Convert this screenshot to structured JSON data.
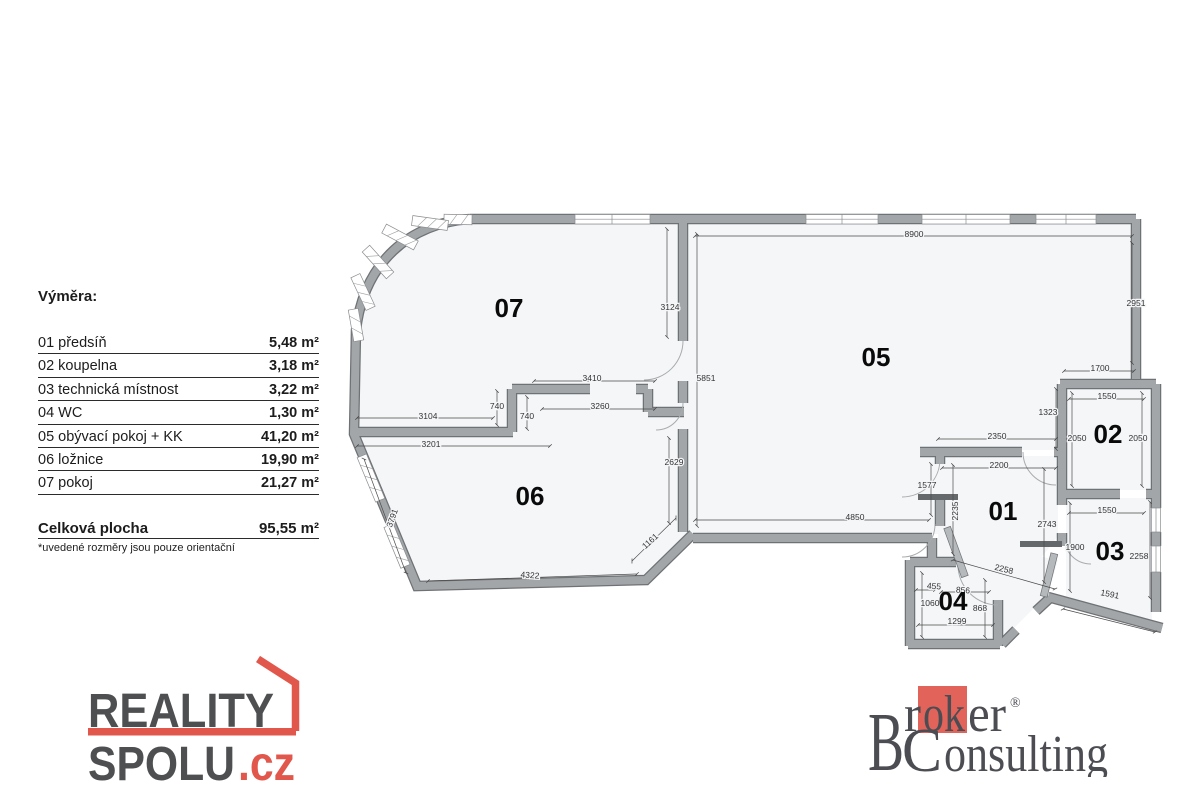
{
  "legend": {
    "title": "Výměra:",
    "rows": [
      {
        "label": "01 předsíň",
        "area": "5,48 m²"
      },
      {
        "label": "02 koupelna",
        "area": "3,18 m²"
      },
      {
        "label": "03 technická místnost",
        "area": "3,22 m²"
      },
      {
        "label": "04 WC",
        "area": "1,30 m²"
      },
      {
        "label": "05 obývací pokoj + KK",
        "area": "41,20 m²"
      },
      {
        "label": "06 ložnice",
        "area": "19,90 m²"
      },
      {
        "label": "07 pokoj",
        "area": "21,27 m²"
      }
    ],
    "total_label": "Celková plocha",
    "total_area": "95,55 m²",
    "disclaimer": "*uvedené rozměry jsou pouze orientační"
  },
  "plan": {
    "rooms": [
      {
        "n": "01",
        "x": 1003,
        "y": 511
      },
      {
        "n": "02",
        "x": 1108,
        "y": 434
      },
      {
        "n": "03",
        "x": 1110,
        "y": 551
      },
      {
        "n": "04",
        "x": 953,
        "y": 601
      },
      {
        "n": "05",
        "x": 876,
        "y": 357
      },
      {
        "n": "06",
        "x": 530,
        "y": 496
      },
      {
        "n": "07",
        "x": 509,
        "y": 308
      }
    ],
    "dims": [
      {
        "t": "8900",
        "x": 914,
        "y": 234,
        "r": 0
      },
      {
        "t": "2951",
        "x": 1136,
        "y": 303,
        "r": 0
      },
      {
        "t": "3124",
        "x": 670,
        "y": 307,
        "r": 0
      },
      {
        "t": "3410",
        "x": 592,
        "y": 378,
        "r": 0
      },
      {
        "t": "5851",
        "x": 706,
        "y": 378,
        "r": 0
      },
      {
        "t": "740",
        "x": 497,
        "y": 406,
        "r": 0
      },
      {
        "t": "3260",
        "x": 600,
        "y": 406,
        "r": 0
      },
      {
        "t": "740",
        "x": 527,
        "y": 416,
        "r": 0
      },
      {
        "t": "3104",
        "x": 428,
        "y": 416,
        "r": 0
      },
      {
        "t": "3201",
        "x": 431,
        "y": 444,
        "r": 0
      },
      {
        "t": "2629",
        "x": 674,
        "y": 462,
        "r": 0
      },
      {
        "t": "4850",
        "x": 855,
        "y": 517,
        "r": 0
      },
      {
        "t": "3791",
        "x": 392,
        "y": 518,
        "r": -70
      },
      {
        "t": "1161",
        "x": 650,
        "y": 541,
        "r": -42
      },
      {
        "t": "4322",
        "x": 530,
        "y": 575,
        "r": 4
      },
      {
        "t": "1700",
        "x": 1100,
        "y": 368,
        "r": 0
      },
      {
        "t": "1550",
        "x": 1107,
        "y": 396,
        "r": 0
      },
      {
        "t": "1323",
        "x": 1048,
        "y": 412,
        "r": 0
      },
      {
        "t": "2350",
        "x": 997,
        "y": 436,
        "r": 0
      },
      {
        "t": "2050",
        "x": 1077,
        "y": 438,
        "r": 0
      },
      {
        "t": "2050",
        "x": 1138,
        "y": 438,
        "r": 0
      },
      {
        "t": "2200",
        "x": 999,
        "y": 465,
        "r": 0
      },
      {
        "t": "1577",
        "x": 927,
        "y": 485,
        "r": 0
      },
      {
        "t": "2235",
        "x": 955,
        "y": 511,
        "r": -90
      },
      {
        "t": "2743",
        "x": 1047,
        "y": 524,
        "r": 0
      },
      {
        "t": "1550",
        "x": 1107,
        "y": 510,
        "r": 0
      },
      {
        "t": "1900",
        "x": 1075,
        "y": 547,
        "r": 0
      },
      {
        "t": "2258",
        "x": 1139,
        "y": 556,
        "r": 0
      },
      {
        "t": "2258",
        "x": 1004,
        "y": 569,
        "r": 14
      },
      {
        "t": "1591",
        "x": 1110,
        "y": 594,
        "r": 11
      },
      {
        "t": "455",
        "x": 934,
        "y": 586,
        "r": 4
      },
      {
        "t": "856",
        "x": 963,
        "y": 590,
        "r": 4
      },
      {
        "t": "1060",
        "x": 930,
        "y": 603,
        "r": 0
      },
      {
        "t": "868",
        "x": 980,
        "y": 608,
        "r": 0
      },
      {
        "t": "1299",
        "x": 957,
        "y": 621,
        "r": 0
      }
    ]
  },
  "logos": {
    "reality": {
      "line1": "REALITY",
      "line2": "SPOLU",
      "tld": ".cz"
    },
    "broker": {
      "initial": "B",
      "part1": "r",
      "highlight": "ok",
      "part2": "er",
      "registered": "®",
      "line2_initial": "C",
      "line2_rest": "onsulting"
    }
  },
  "colors": {
    "accent_red": "#e2574c",
    "broker_red": "#e2635a",
    "wall_gray": "#a3a6a9",
    "floor": "#f4f6f8",
    "logo_gray": "#4e4f51"
  }
}
